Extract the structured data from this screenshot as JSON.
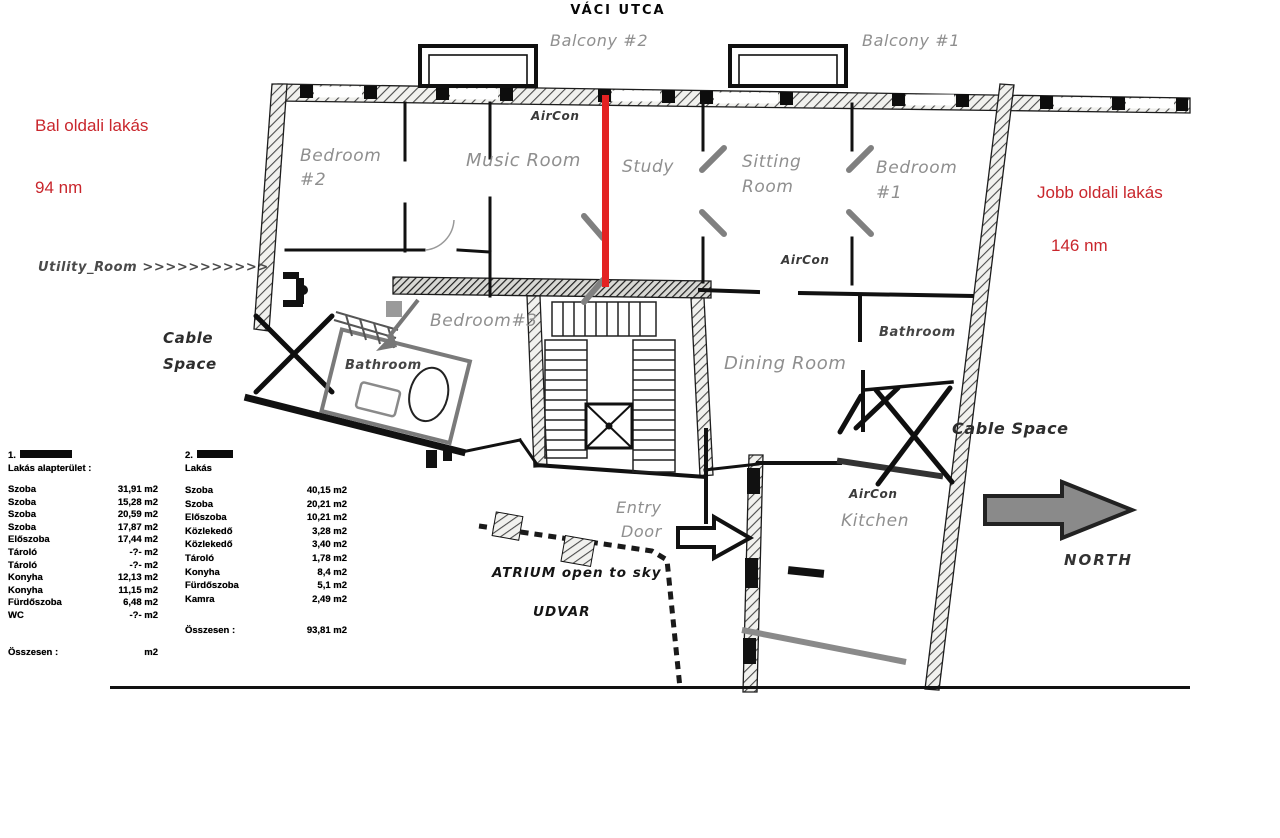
{
  "street": "VÁCI UTCA",
  "red_annotations": {
    "left_title": "Bal oldali lakás",
    "left_area": "94 nm",
    "right_title": "Jobb oldali lakás",
    "right_area": "146 nm",
    "color": "#c9262c"
  },
  "plan_labels": {
    "balcony_2": "Balcony #2",
    "balcony_1": "Balcony #1",
    "aircon_music": "AirCon",
    "bedroom2_line1": "Bedroom",
    "bedroom2_line2": "#2",
    "music_room": "Music Room",
    "study": "Study",
    "sitting_line1": "Sitting",
    "sitting_line2": "Room",
    "bedroom1_line1": "Bedroom",
    "bedroom1_line2": "#1",
    "aircon_sitting": "AirCon",
    "utility": "Utility_Room  >>>>>>>>>>>",
    "cable_left_line1": "Cable",
    "cable_left_line2": "Space",
    "bedroom3": "Bedroom#3",
    "bathroom_left": "Bathroom",
    "dining_room": "Dining Room",
    "bathroom_right": "Bathroom",
    "cable_right": "Cable Space",
    "aircon_kitchen": "AirCon",
    "kitchen": "Kitchen",
    "entry_line1": "Entry",
    "entry_line2": "Door",
    "atrium": "ATRIUM open to sky",
    "udvar": "UDVAR",
    "north": "NORTH"
  },
  "area_tables": {
    "left": {
      "prefix": "1.",
      "subtitle": "Lakás alapterület :",
      "rows": [
        {
          "name": "Szoba",
          "value": "31,91 m2"
        },
        {
          "name": "Szoba",
          "value": "15,28 m2"
        },
        {
          "name": "Szoba",
          "value": "20,59 m2"
        },
        {
          "name": "Szoba",
          "value": "17,87 m2"
        },
        {
          "name": "Előszoba",
          "value": "17,44 m2"
        },
        {
          "name": "Tároló",
          "value": "-?- m2"
        },
        {
          "name": "Tároló",
          "value": "-?- m2"
        },
        {
          "name": "Konyha",
          "value": "12,13 m2"
        },
        {
          "name": "Konyha",
          "value": "11,15 m2"
        },
        {
          "name": "Fürdőszoba",
          "value": "6,48 m2"
        },
        {
          "name": "WC",
          "value": "-?- m2"
        }
      ],
      "total_label": "Összesen :",
      "total_value": "m2"
    },
    "right": {
      "prefix": "2.",
      "subtitle": "Lakás",
      "rows": [
        {
          "name": "Szoba",
          "value": "40,15 m2"
        },
        {
          "name": "Szoba",
          "value": "20,21 m2"
        },
        {
          "name": "Előszoba",
          "value": "10,21 m2"
        },
        {
          "name": "Közlekedő",
          "value": "3,28 m2"
        },
        {
          "name": "Közlekedő",
          "value": "3,40 m2"
        },
        {
          "name": "Tároló",
          "value": "1,78 m2"
        },
        {
          "name": "Konyha",
          "value": "8,4 m2"
        },
        {
          "name": "Fürdőszoba",
          "value": "5,1 m2"
        },
        {
          "name": "Kamra",
          "value": "2,49 m2"
        }
      ],
      "total_label": "Összesen :",
      "total_value": "93,81 m2"
    }
  },
  "colors": {
    "divider_red": "#e32222",
    "north_arrow_gray": "#8a8a8a",
    "label_gray": "#8f8f8f"
  }
}
